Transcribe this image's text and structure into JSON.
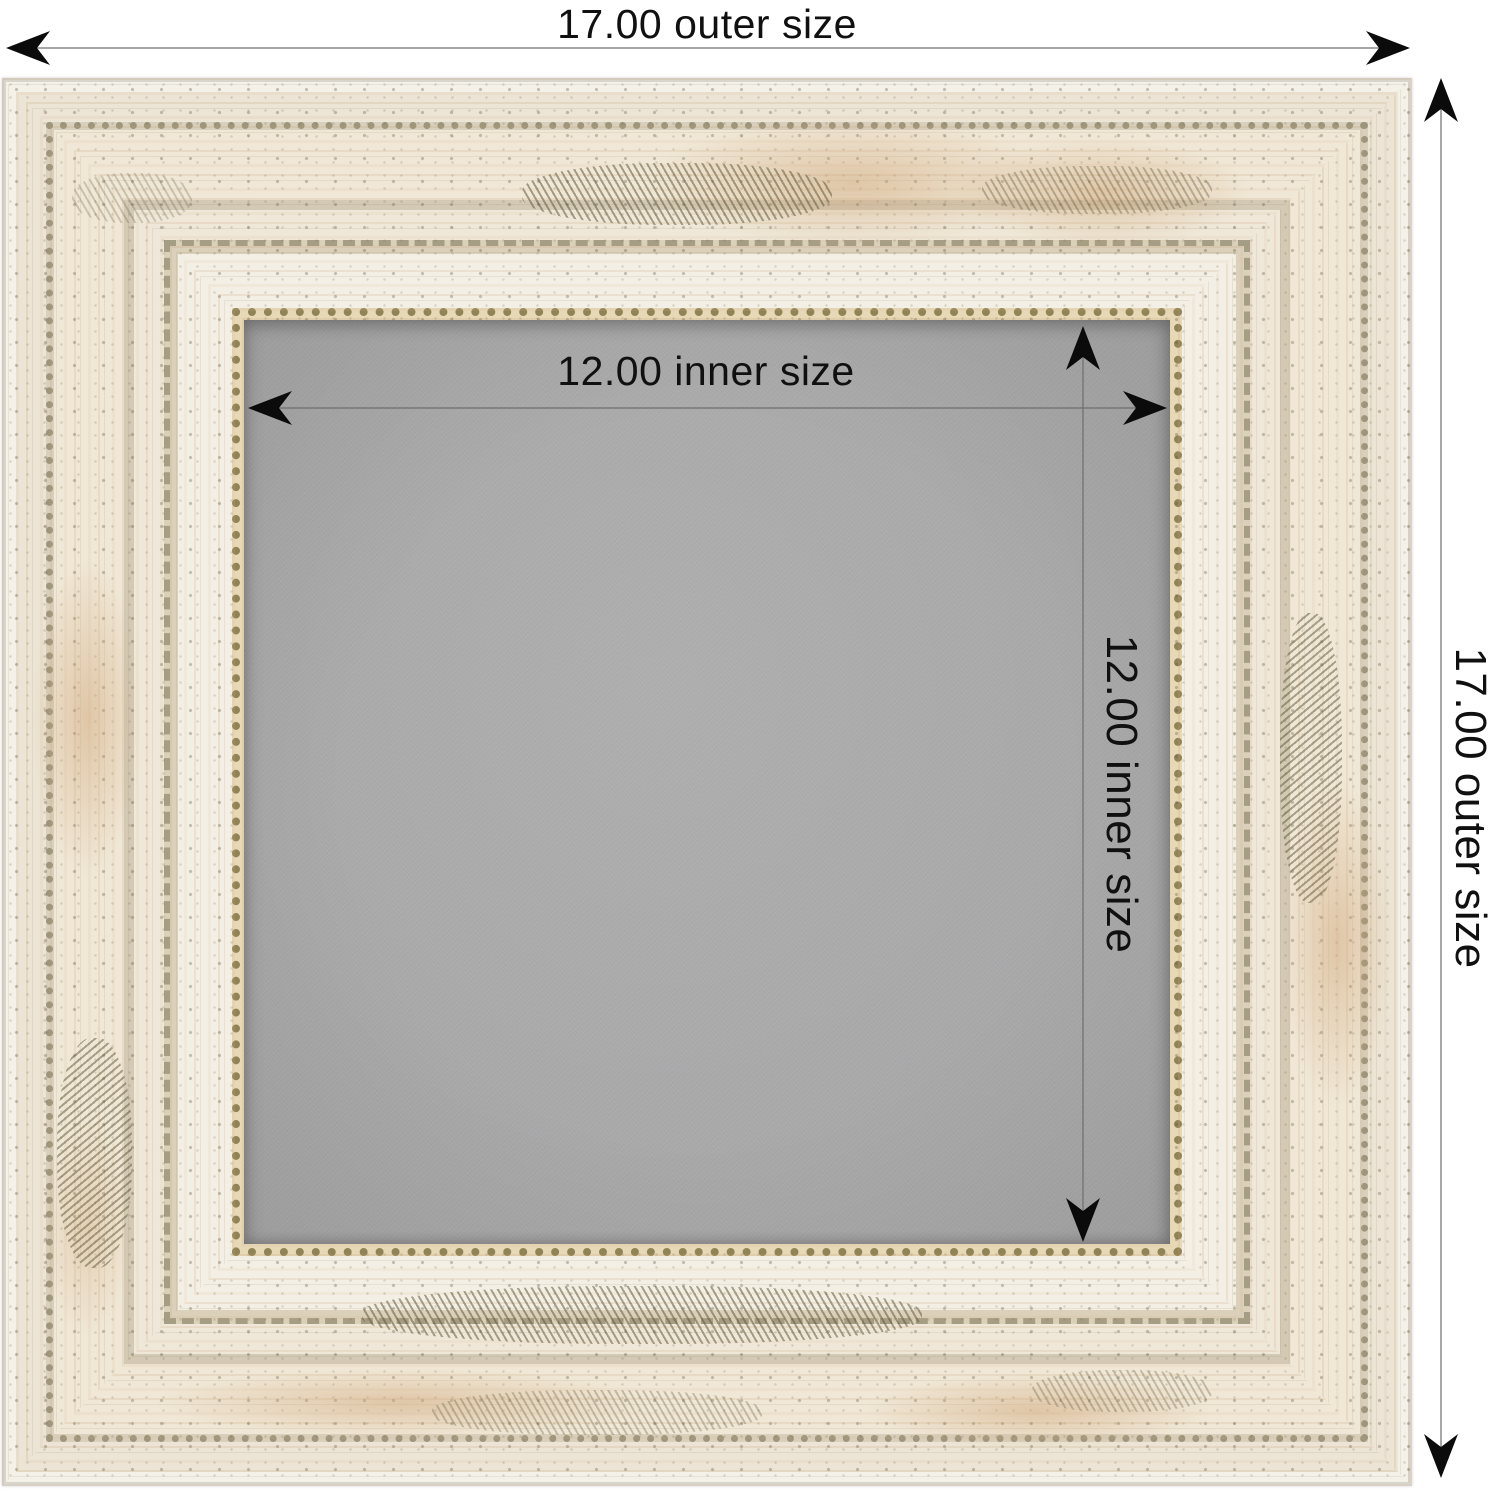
{
  "scene": {
    "subject": "distressed whitewash picture frame with gray inner board, annotated with outer and inner dimensions"
  },
  "annotations": {
    "outer_width": {
      "label": "17.00 outer size",
      "value": 17.0,
      "orientation": "horizontal",
      "position": "top"
    },
    "outer_height": {
      "label": "17.00 outer size",
      "value": 17.0,
      "orientation": "vertical",
      "position": "right"
    },
    "inner_width": {
      "label": "12.00 inner size",
      "value": 12.0,
      "orientation": "horizontal",
      "position": "inside-top"
    },
    "inner_height": {
      "label": "12.00 inner size",
      "value": 12.0,
      "orientation": "vertical",
      "position": "inside-right"
    }
  },
  "colors": {
    "background": "#ffffff",
    "frame_cream": "#f0e8d8",
    "frame_tan": "#d2a97e",
    "frame_speckle_olive": "#6e6840",
    "gold_lip": "#a89155",
    "board_gray": "#a9a9aa",
    "dimension_line": "#808080",
    "arrowhead": "#0b0b0b",
    "label_text": "#101010"
  }
}
